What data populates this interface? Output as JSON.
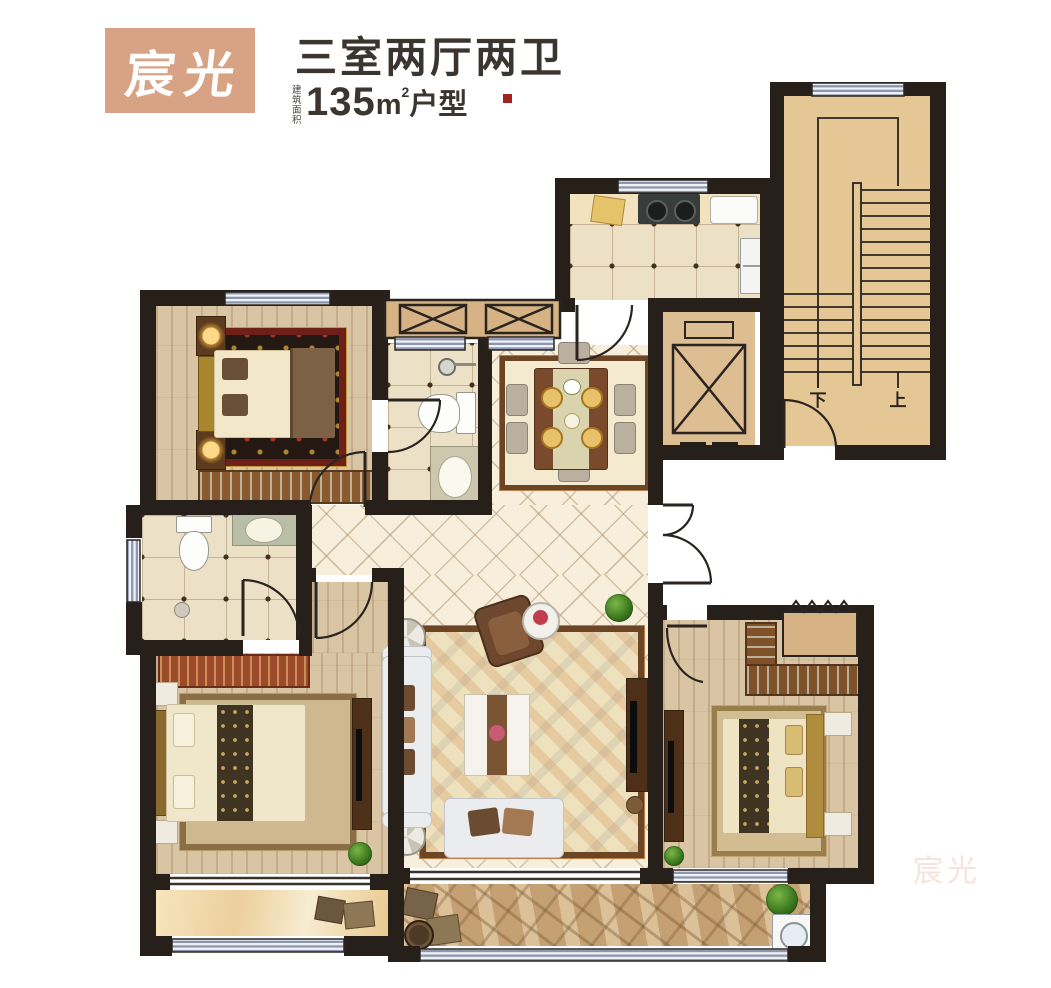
{
  "header": {
    "badge_text": "宸光",
    "title": "三室两厅两卫",
    "area_label": "建筑面积",
    "area_value": "135",
    "area_unit": "m",
    "area_exponent": "2",
    "area_suffix": "户型"
  },
  "plan": {
    "stairs": {
      "down_label": "下",
      "up_label": "上"
    }
  },
  "watermark": "宸光",
  "colors": {
    "badge_bg": "#d8a385",
    "text_dark": "#3b3530",
    "accent_red": "#a3231c",
    "wall": "#261f1a",
    "stair_tan": "#e4c795",
    "ac_band_tan": "#d6b285",
    "window_stripe": "#8d96ac",
    "wood_floor": "#d9c5a4",
    "cream_tile": "#f7efdc",
    "balcony_stone": "#c4a073"
  }
}
